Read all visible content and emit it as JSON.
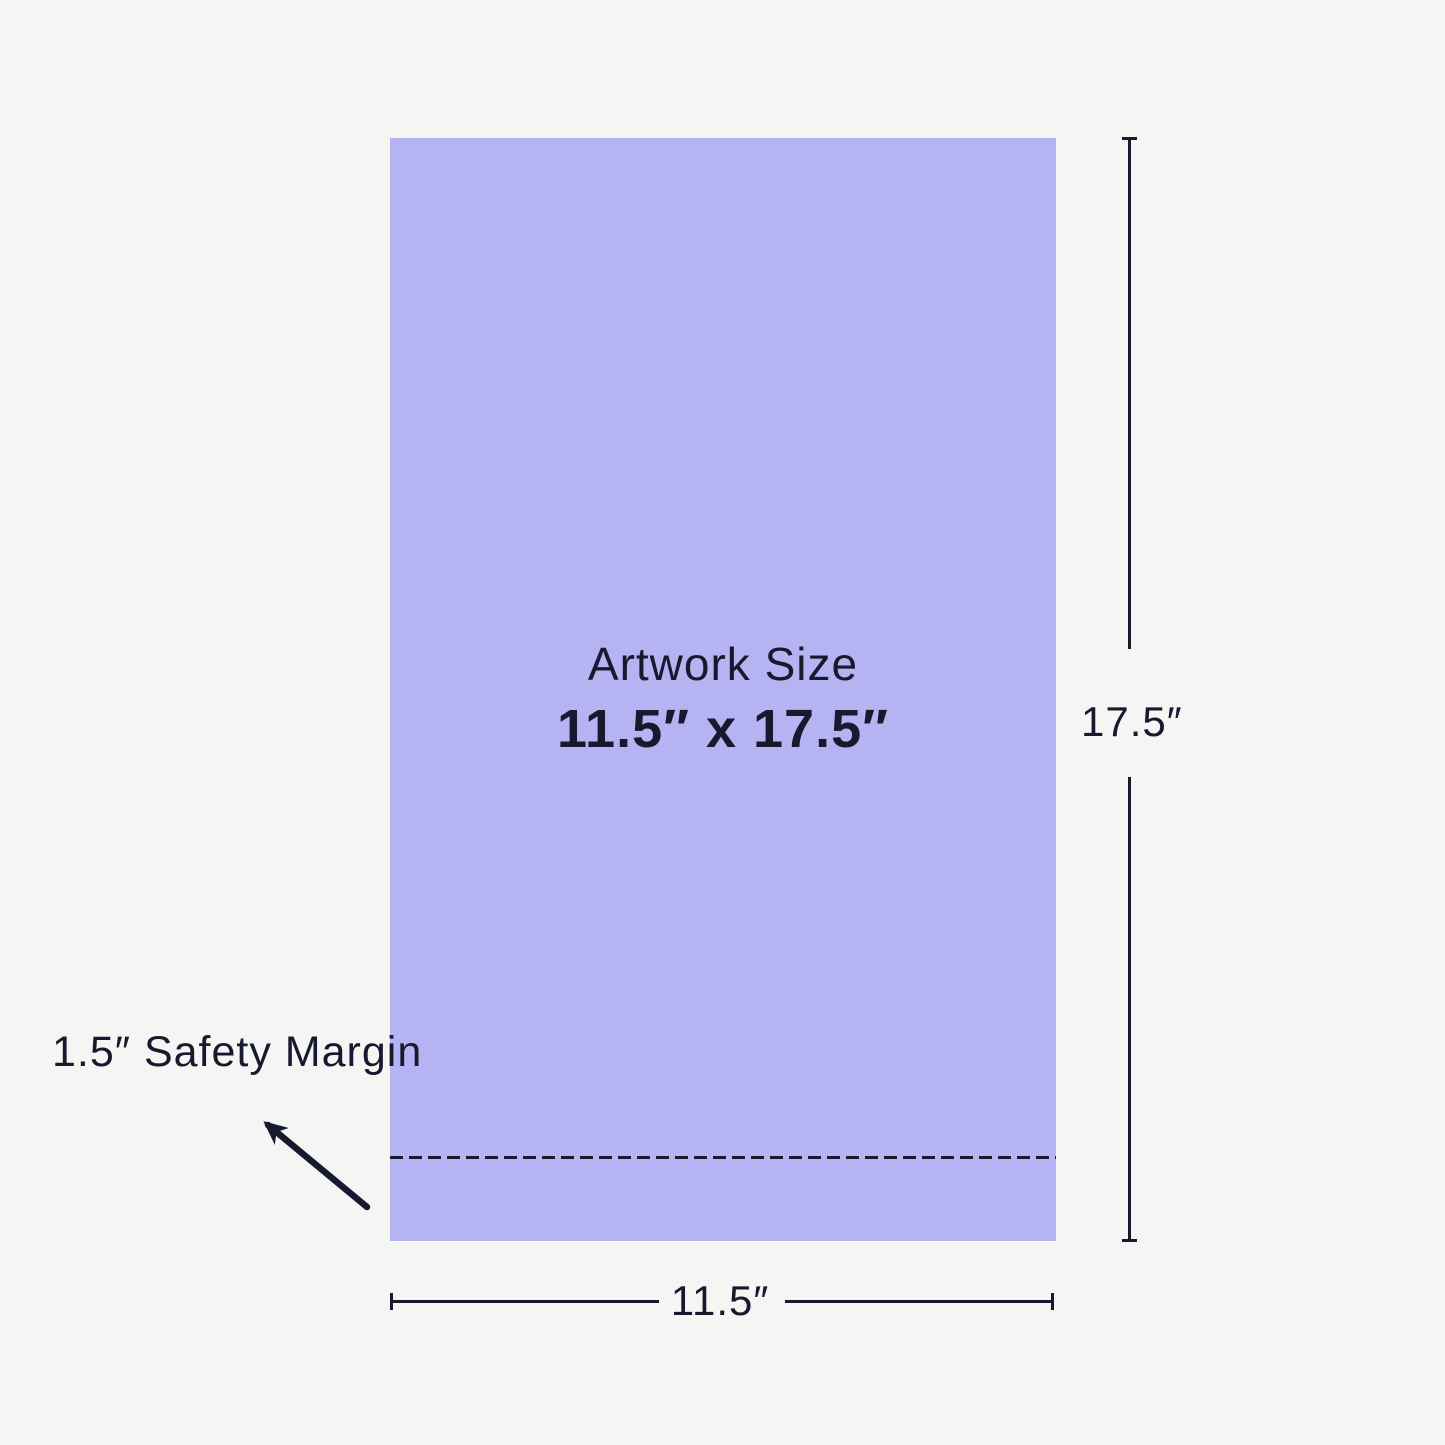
{
  "diagram": {
    "artwork": {
      "title": "Artwork Size",
      "size": "11.5″ x 17.5″"
    },
    "height_dimension": {
      "label": "17.5″"
    },
    "width_dimension": {
      "label": "11.5″"
    },
    "safety_margin": {
      "label": "1.5″ Safety Margin"
    }
  },
  "colors": {
    "background": "#f5f5f4",
    "artwork-fill": "#b5b3f2",
    "ink": "#171a2e"
  }
}
